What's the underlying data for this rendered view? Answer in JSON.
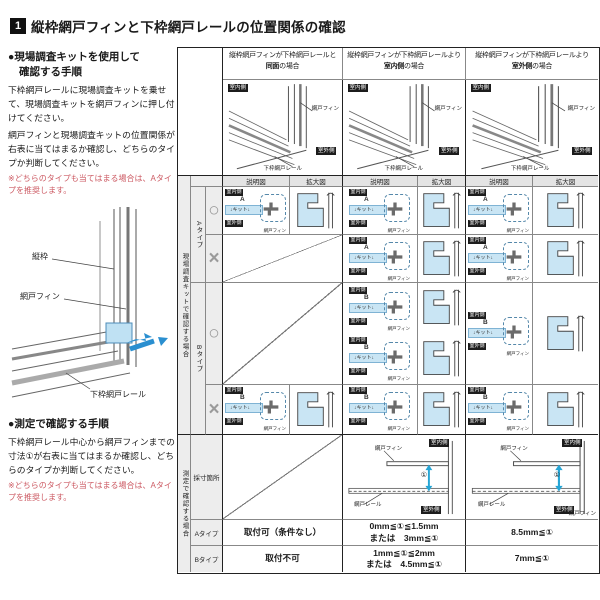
{
  "title": {
    "number": "1",
    "text": "縦枠網戸フィンと下枠網戸レールの位置関係の確認"
  },
  "sidebar": {
    "kit_heading_l1": "●現場調査キットを使用して",
    "kit_heading_l2": "確認する手順",
    "kit_para1": "下枠網戸レールに現場調査キットを乗せて、現場調査キットを網戸フィンに押し付けてください。",
    "kit_para2": "網戸フィンと現場調査キットの位置関係が右表に当てはまるか確認し、どちらのタイプか判断してください。",
    "kit_note": "※どちらのタイプも当てはまる場合は、Aタイプを推奨します。",
    "diagram": {
      "vertical_frame": "縦枠",
      "fin": "網戸フィン",
      "rail": "下枠網戸レール"
    },
    "measure_heading": "●測定で確認する手順",
    "measure_para": "下枠網戸レール中心から網戸フィンまでの寸法①が右表に当てはまるか確認し、どちらのタイプか判断してください。",
    "measure_note": "※どちらのタイプも当てはまる場合は、Aタイプを推奨します。"
  },
  "table": {
    "col1_title_prefix": "縦枠網戸フィンが下枠網戸レールと",
    "col1_title_bold": "同面",
    "col1_title_suffix": "の場合",
    "col2_title_prefix": "縦枠網戸フィンが下枠網戸レールより",
    "col2_title_bold": "室内側",
    "col2_title_suffix": "の場合",
    "col3_title_prefix": "縦枠網戸フィンが下枠網戸レールより",
    "col3_title_bold": "室外側",
    "col3_title_suffix": "の場合",
    "labels": {
      "indoor": "室内側",
      "outdoor": "室外側",
      "fin": "網戸フィン",
      "rail": "下枠網戸レール",
      "rail_short": "網戸レール",
      "explain": "説明図",
      "zoom": "拡大図",
      "kit_caption": "現場調査キットで確認する場合",
      "measure_caption": "測定で確認する場合",
      "type_a": "Aタイプ",
      "type_b": "Bタイプ",
      "ok": "○",
      "ng": "×",
      "kit_a": "A",
      "kit_b": "B",
      "kit_word": "キット",
      "arrow_down": "↓",
      "measure_row": "採寸箇所",
      "dim": "①"
    },
    "results": {
      "a1": "取付可（条件なし）",
      "a2l1": "0mm≦①≦1.5mm",
      "a2l2": "または　3mm≦①",
      "a3": "8.5mm≦①",
      "b1": "取付不可",
      "b2l1": "1mm≦①≦2mm",
      "b2l2": "または　4.5mm≦①",
      "b3": "7mm≦①"
    }
  }
}
